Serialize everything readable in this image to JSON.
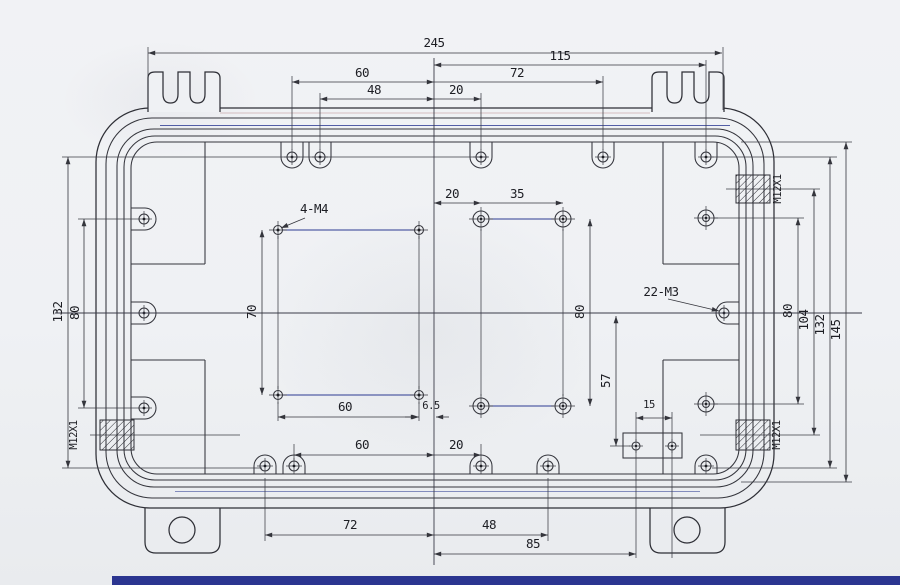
{
  "drawing": {
    "dim_top": {
      "overall": "245",
      "half_right": "115",
      "d60": "60",
      "d72": "72",
      "d48": "48",
      "d20": "20"
    },
    "dim_bottom": {
      "d60": "60",
      "d20": "20",
      "d72": "72",
      "d48": "48",
      "d85": "85"
    },
    "dim_left": {
      "d132": "132",
      "d80": "80"
    },
    "dim_right": {
      "d80": "80",
      "d104": "104",
      "d132": "132",
      "d145": "145"
    },
    "pattern_m4": {
      "label": "4-M4",
      "width": "60",
      "height": "70",
      "offset": "6.5"
    },
    "pattern_center": {
      "d20": "20",
      "d35": "35",
      "d80": "80"
    },
    "bracket": {
      "d57": "57",
      "d15": "15"
    },
    "notes": {
      "thread": "22-M3",
      "gland": "M12X1"
    }
  }
}
